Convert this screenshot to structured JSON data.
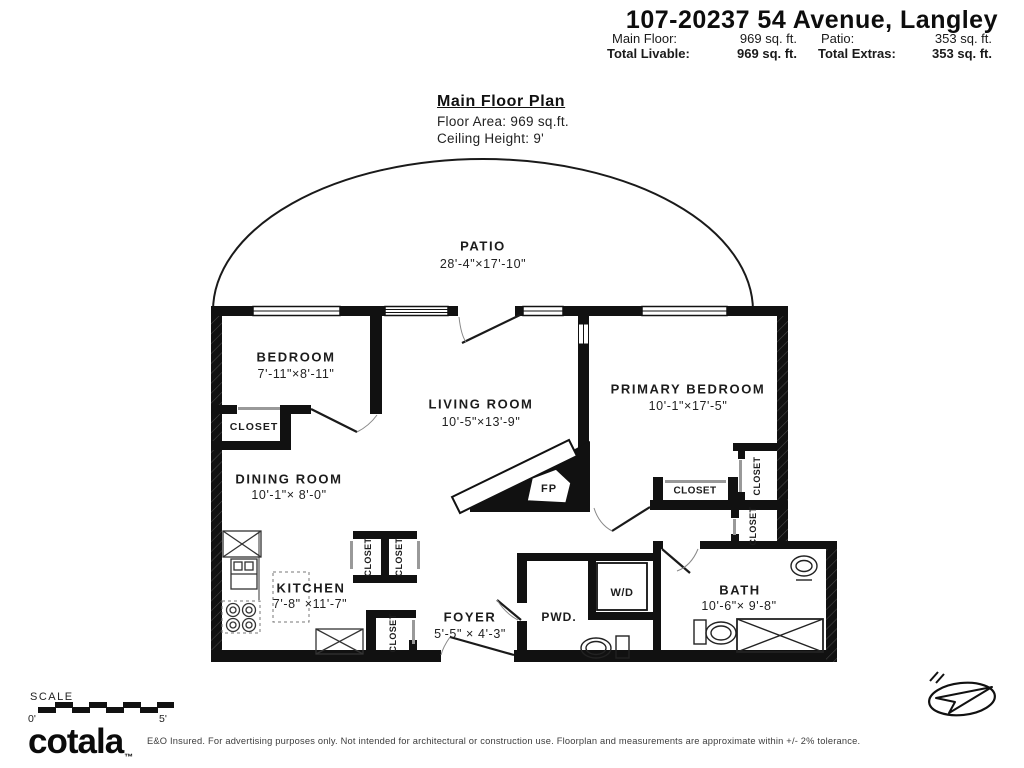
{
  "header": {
    "title": "107-20237 54 Avenue, Langley",
    "row1": {
      "label1": "Main Floor:",
      "value1": "969 sq. ft.",
      "label2": "Patio:",
      "value2": "353 sq. ft."
    },
    "row2": {
      "label1": "Total Livable:",
      "value1": "969 sq. ft.",
      "label2": "Total Extras:",
      "value2": "353 sq. ft."
    }
  },
  "plan_title": {
    "title": "Main Floor Plan",
    "floor_area": "Floor Area: 969 sq.ft.",
    "ceiling": "Ceiling Height: 9'"
  },
  "rooms": {
    "patio": {
      "name": "PATIO",
      "dims": "28'-4\"×17'-10\""
    },
    "bedroom": {
      "name": "BEDROOM",
      "dims": "7'-11\"×8'-11\""
    },
    "living": {
      "name": "LIVING ROOM",
      "dims": "10'-5\"×13'-9\""
    },
    "primary": {
      "name": "PRIMARY BEDROOM",
      "dims": "10'-1\"×17'-5\""
    },
    "dining": {
      "name": "DINING ROOM",
      "dims": "10'-1\"× 8'-0\""
    },
    "kitchen": {
      "name": "KITCHEN",
      "dims": "7'-8\" ×11'-7\""
    },
    "foyer": {
      "name": "FOYER",
      "dims": "5'-5\" × 4'-3\""
    },
    "pwd": {
      "name": "PWD."
    },
    "wd": {
      "name": "W/D"
    },
    "bath": {
      "name": "BATH",
      "dims": "10'-6\"× 9'-8\""
    },
    "closet": {
      "name": "CLOSET"
    },
    "fireplace": {
      "name": "FP"
    }
  },
  "scale_bar": {
    "label": "SCALE",
    "min": "0'",
    "max": "5'"
  },
  "footer": {
    "logo": "cotala",
    "trademark": "™",
    "disclaimer": "E&O Insured. For advertising purposes only. Not intended for architectural or construction use. Floorplan and measurements are approximate within +/- 2% tolerance."
  },
  "icons": {
    "compass": "north-arrow-icon"
  },
  "colors": {
    "wall": "#111111",
    "text": "#1a1a1a",
    "door_arc": "#888888"
  }
}
